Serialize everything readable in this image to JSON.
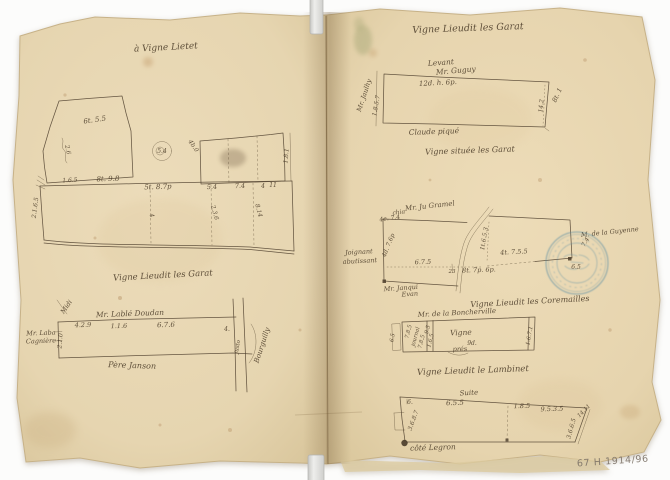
{
  "document_type": "scanned manuscript survey notebook (two-page spread, hand-drawn vineyard parcel plans)",
  "stamp": {
    "color": "#4e87a3"
  },
  "annotations": {
    "archive_ref": [
      {
        "t": "67 H 1914/96",
        "x": 613,
        "y": 464,
        "r": -4,
        "s": 9.5,
        "cls": "pencil"
      }
    ]
  },
  "left_page": {
    "title": [
      {
        "t": "à Vigne Lietet",
        "x": 166,
        "y": 50,
        "r": -3,
        "s": 9
      }
    ],
    "sketch_top_labels": [
      {
        "t": "6t. 5.5",
        "x": 95,
        "y": 122,
        "r": -8,
        "s": 7
      },
      {
        "t": "2.6",
        "x": 66,
        "y": 150,
        "r": 78,
        "s": 6
      },
      {
        "t": "1.6.5",
        "x": 70,
        "y": 182,
        "r": -3,
        "s": 6
      },
      {
        "t": "8t. 9.8",
        "x": 108,
        "y": 181,
        "r": -2,
        "s": 7
      },
      {
        "t": "5t. 8.7p",
        "x": 158,
        "y": 189,
        "r": -2,
        "s": 7
      },
      {
        "t": "5.4",
        "x": 212,
        "y": 189,
        "r": -2,
        "s": 6.5
      },
      {
        "t": "7.4",
        "x": 240,
        "y": 188,
        "r": -2,
        "s": 6.5
      },
      {
        "t": "4",
        "x": 263,
        "y": 188,
        "r": 0,
        "s": 6
      },
      {
        "t": "11",
        "x": 273,
        "y": 187,
        "r": 0,
        "s": 6
      },
      {
        "t": "5.4",
        "x": 162,
        "y": 153,
        "r": 0,
        "s": 6,
        "o": 0.5
      },
      {
        "t": "4b.0",
        "x": 192,
        "y": 147,
        "r": 55,
        "s": 6
      },
      {
        "t": "1.8.1",
        "x": 288,
        "y": 156,
        "r": -85,
        "s": 6
      },
      {
        "t": "2.1.6.5",
        "x": 37,
        "y": 208,
        "r": -83,
        "s": 6
      },
      {
        "t": "4",
        "x": 150,
        "y": 216,
        "r": 75,
        "s": 6
      },
      {
        "t": "2.3.6",
        "x": 213,
        "y": 213,
        "r": 75,
        "s": 6
      },
      {
        "t": "8.14",
        "x": 257,
        "y": 211,
        "r": 75,
        "s": 6
      }
    ],
    "subtitle": [
      {
        "t": "Vigne Lieudit les Garat",
        "x": 163,
        "y": 278,
        "r": -3,
        "s": 8.5
      }
    ],
    "sketch_bottom_labels": [
      {
        "t": "Midi",
        "x": 68,
        "y": 308,
        "r": -55,
        "s": 6.5,
        "o": 0.6
      },
      {
        "t": "Mr. Lablé Doudan",
        "x": 130,
        "y": 316,
        "r": -2,
        "s": 7.5
      },
      {
        "t": "4.2.9",
        "x": 83,
        "y": 327,
        "r": -2,
        "s": 6.5
      },
      {
        "t": "1.1.6",
        "x": 119,
        "y": 328,
        "r": -2,
        "s": 6.5
      },
      {
        "t": "6.7.6",
        "x": 166,
        "y": 327,
        "r": -2,
        "s": 7
      },
      {
        "t": "Mr. Laba",
        "x": 41,
        "y": 335,
        "r": -2,
        "s": 6.5
      },
      {
        "t": "Cagnière",
        "x": 41,
        "y": 343,
        "r": -2,
        "s": 6.5
      },
      {
        "t": "2.1.0",
        "x": 62,
        "y": 341,
        "r": -85,
        "s": 6
      },
      {
        "t": "Père Janson",
        "x": 132,
        "y": 368,
        "r": 2,
        "s": 8
      },
      {
        "t": "4.",
        "x": 227,
        "y": 331,
        "r": 0,
        "s": 6
      },
      {
        "t": "justo",
        "x": 239,
        "y": 347,
        "r": -80,
        "s": 5.5
      },
      {
        "t": "Bourguilly",
        "x": 264,
        "y": 346,
        "r": -72,
        "s": 7
      }
    ]
  },
  "right_page": {
    "title": [
      {
        "t": "Vigne Lieudit les Garat",
        "x": 468,
        "y": 31,
        "r": -2,
        "s": 9.5
      }
    ],
    "sketch1_labels": [
      {
        "t": "Levant",
        "x": 441,
        "y": 65,
        "r": -4,
        "s": 7.5
      },
      {
        "t": "Mr. Guguy",
        "x": 456,
        "y": 73,
        "r": -5,
        "s": 7.5
      },
      {
        "t": "12d. h. 6p.",
        "x": 438,
        "y": 85,
        "r": -3,
        "s": 7
      },
      {
        "t": "Mr. Jaulhy",
        "x": 366,
        "y": 96,
        "r": -72,
        "s": 6.5
      },
      {
        "t": "1.8.5.7",
        "x": 378,
        "y": 106,
        "r": -80,
        "s": 6
      },
      {
        "t": "14.2",
        "x": 543,
        "y": 106,
        "r": -85,
        "s": 6
      },
      {
        "t": "8t. 1",
        "x": 559,
        "y": 96,
        "r": -65,
        "s": 6.5
      },
      {
        "t": "Claude piqué",
        "x": 434,
        "y": 134,
        "r": -2,
        "s": 7.5
      }
    ],
    "caption1": [
      {
        "t": "Vigne située les Garat",
        "x": 470,
        "y": 153,
        "r": -2,
        "s": 8
      }
    ],
    "sketch2_labels": [
      {
        "t": "Mr. Ju Gramel",
        "x": 430,
        "y": 208,
        "r": -6,
        "s": 7
      },
      {
        "t": "chia",
        "x": 399,
        "y": 214,
        "r": -8,
        "s": 6
      },
      {
        "t": "4e. 7.4",
        "x": 390,
        "y": 220,
        "r": -8,
        "s": 6
      },
      {
        "t": "4d. 7.6p",
        "x": 390,
        "y": 246,
        "r": -68,
        "s": 6
      },
      {
        "t": "Joignant",
        "x": 359,
        "y": 254,
        "r": -3,
        "s": 6.5
      },
      {
        "t": "abutissant",
        "x": 360,
        "y": 263,
        "r": -3,
        "s": 6.5
      },
      {
        "t": "Mr. Janqui",
        "x": 401,
        "y": 290,
        "r": -4,
        "s": 6.5
      },
      {
        "t": "Evan",
        "x": 410,
        "y": 296,
        "r": -4,
        "s": 6.5
      },
      {
        "t": "6.7.5",
        "x": 423,
        "y": 264,
        "r": -2,
        "s": 6.5
      },
      {
        "t": "23",
        "x": 452,
        "y": 273,
        "r": 0,
        "s": 5.5
      },
      {
        "t": "8t. 7p. 6p.",
        "x": 479,
        "y": 272,
        "r": -2,
        "s": 6.5
      },
      {
        "t": "1t.6.5.3",
        "x": 486,
        "y": 239,
        "r": -80,
        "s": 6
      },
      {
        "t": "4t. 7.5.5",
        "x": 514,
        "y": 254,
        "r": -3,
        "s": 6.5
      },
      {
        "t": "M. de la Guyenne",
        "x": 610,
        "y": 234,
        "r": -6,
        "s": 6.5
      },
      {
        "t": "7.4",
        "x": 587,
        "y": 243,
        "r": -60,
        "s": 6
      },
      {
        "t": "6.5",
        "x": 576,
        "y": 269,
        "r": 0,
        "s": 6
      }
    ],
    "caption2": [
      {
        "t": "Vigne Lieudit les Coremailles",
        "x": 530,
        "y": 304,
        "r": -3,
        "s": 8
      }
    ],
    "sketch3_labels": [
      {
        "t": "Mr. de la Boncherville",
        "x": 457,
        "y": 315,
        "r": -3,
        "s": 7
      },
      {
        "t": "6.5",
        "x": 394,
        "y": 338,
        "r": -80,
        "s": 5.5
      },
      {
        "t": "7.8.5",
        "x": 410,
        "y": 332,
        "r": -75,
        "s": 5.5
      },
      {
        "t": "journal",
        "x": 417,
        "y": 337,
        "r": -75,
        "s": 5.5
      },
      {
        "t": "7.8.5",
        "x": 423,
        "y": 342,
        "r": -75,
        "s": 5.5
      },
      {
        "t": "9.5",
        "x": 429,
        "y": 330,
        "r": -75,
        "s": 5.5
      },
      {
        "t": "1.6.5",
        "x": 432,
        "y": 341,
        "r": -75,
        "s": 5.5
      },
      {
        "t": "Vigne",
        "x": 461,
        "y": 335,
        "r": -2,
        "s": 7.5
      },
      {
        "t": "9d.",
        "x": 472,
        "y": 345,
        "r": 0,
        "s": 6
      },
      {
        "t": "prés",
        "x": 460,
        "y": 351,
        "r": -2,
        "s": 6.5
      },
      {
        "t": "1.6.7.1",
        "x": 531,
        "y": 336,
        "r": -80,
        "s": 5.5
      }
    ],
    "caption3": [
      {
        "t": "Vigne Lieudit le Lambinet",
        "x": 473,
        "y": 373,
        "r": -2,
        "s": 8.5
      }
    ],
    "sketch4_labels": [
      {
        "t": "Suite",
        "x": 469,
        "y": 395,
        "r": -3,
        "s": 7
      },
      {
        "t": "6.",
        "x": 410,
        "y": 404,
        "r": 0,
        "s": 6
      },
      {
        "t": "6.5.5",
        "x": 455,
        "y": 405,
        "r": -2,
        "s": 7
      },
      {
        "t": "1.8.5",
        "x": 522,
        "y": 408,
        "r": -2,
        "s": 6.5
      },
      {
        "t": "9.5.3.5",
        "x": 552,
        "y": 411,
        "r": -2,
        "s": 6.5
      },
      {
        "t": "14.11",
        "x": 585,
        "y": 412,
        "r": -45,
        "s": 5.5
      },
      {
        "t": "3.6.8.7",
        "x": 415,
        "y": 421,
        "r": -70,
        "s": 6
      },
      {
        "t": "3.6.6.5",
        "x": 573,
        "y": 429,
        "r": -75,
        "s": 6
      },
      {
        "t": "côté Legron",
        "x": 433,
        "y": 450,
        "r": -2,
        "s": 7.5
      }
    ]
  }
}
